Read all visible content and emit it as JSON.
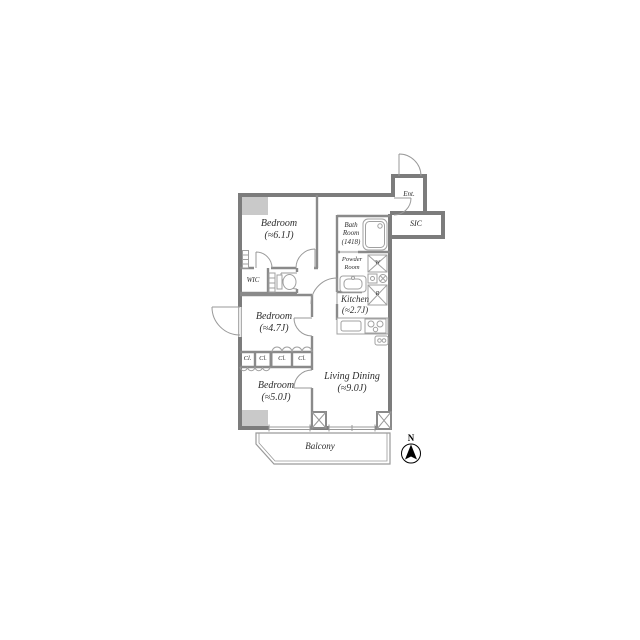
{
  "plan_title": "apartment-floor-plan",
  "rooms": {
    "bedroom1": {
      "name": "Bedroom",
      "area": "(≈6.1J)"
    },
    "bedroom2": {
      "name": "Bedroom",
      "area": "(≈4.7J)"
    },
    "bedroom3": {
      "name": "Bedroom",
      "area": "(≈5.0J)"
    },
    "living": {
      "name": "Living Dining",
      "area": "(≈9.0J)"
    },
    "kitchen": {
      "name": "Kitchen",
      "area": "(≈2.7J)"
    },
    "bath": {
      "l1": "Bath",
      "l2": "Room",
      "l3": "(1418)"
    },
    "powder": {
      "l1": "Powder",
      "l2": "Room"
    }
  },
  "labels": {
    "ent": "Ent.",
    "sic": "SIC",
    "wic": "WIC",
    "cl": "Cl.",
    "balcony": "Balcony",
    "north": "N",
    "washer": "W",
    "fridge": "R"
  },
  "colors": {
    "exterior_wall": "#7c7c7c",
    "interior_wall": "#8a8a8a",
    "fixture_line": "#a0a0a0",
    "door_arc": "#999999",
    "shaft_fill": "#c9c9c9",
    "text": "#2e2e2e",
    "compass": "#000000"
  }
}
